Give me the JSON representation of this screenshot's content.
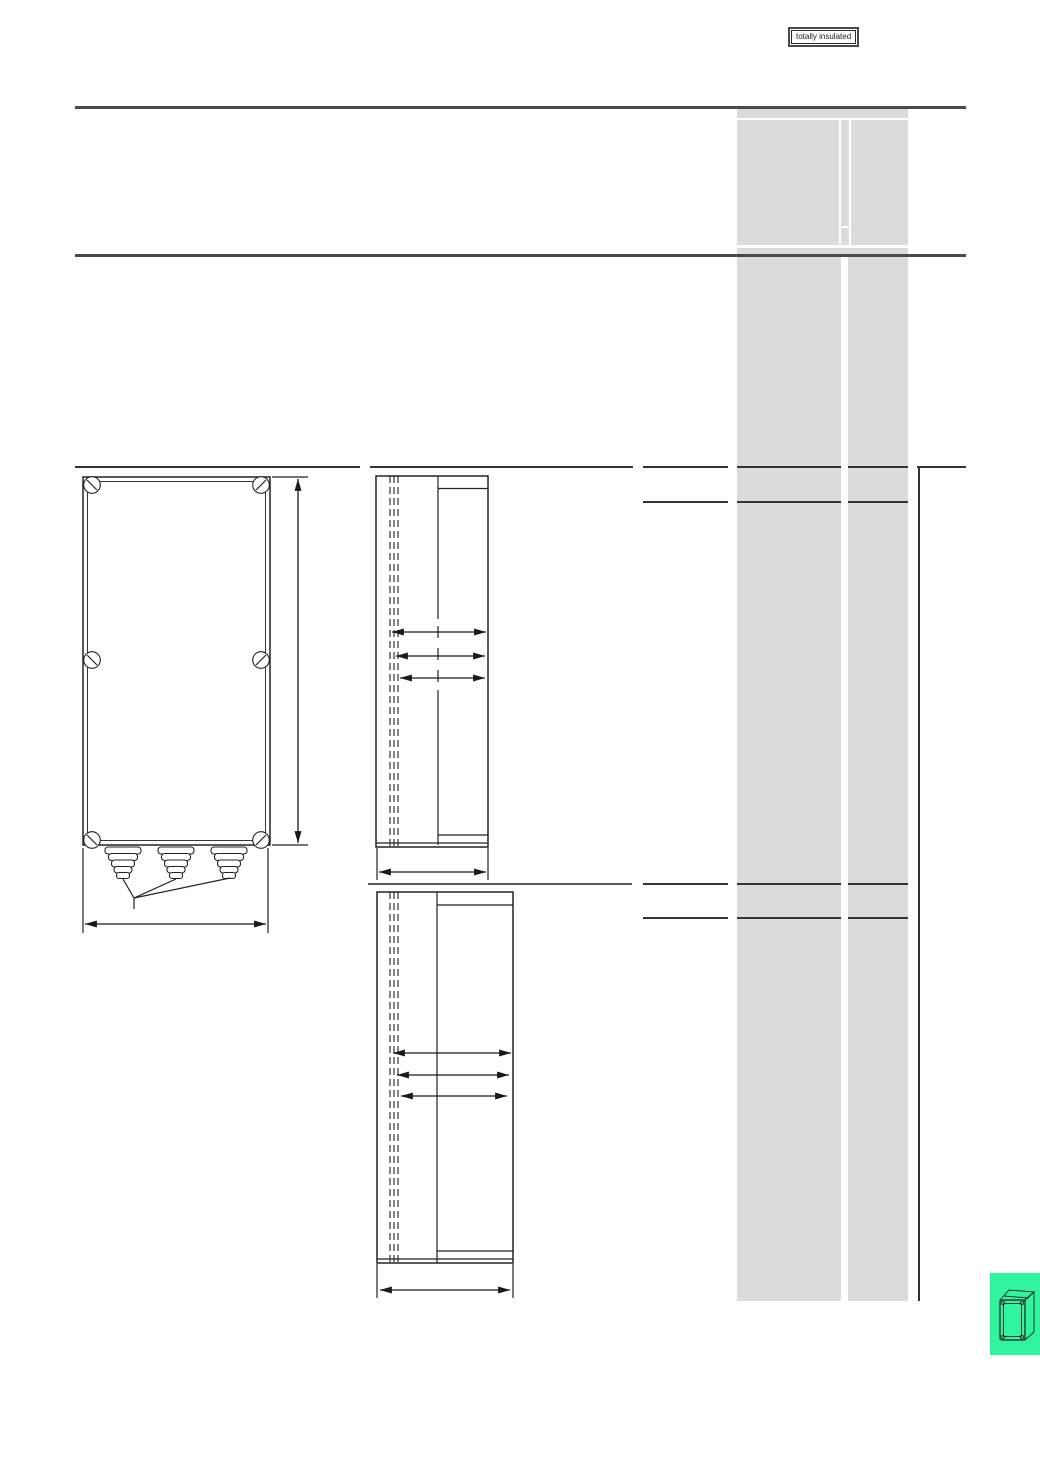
{
  "badge": {
    "label": "totally insulated"
  },
  "colors": {
    "accent_green": "#30f59e",
    "panel_gray": "#dbdbdb",
    "rule_dark": "#4a4a4a",
    "line_dark": "#333333"
  },
  "icons": {
    "enclosure_3d_icon": "isometric wireframe enclosure box"
  }
}
